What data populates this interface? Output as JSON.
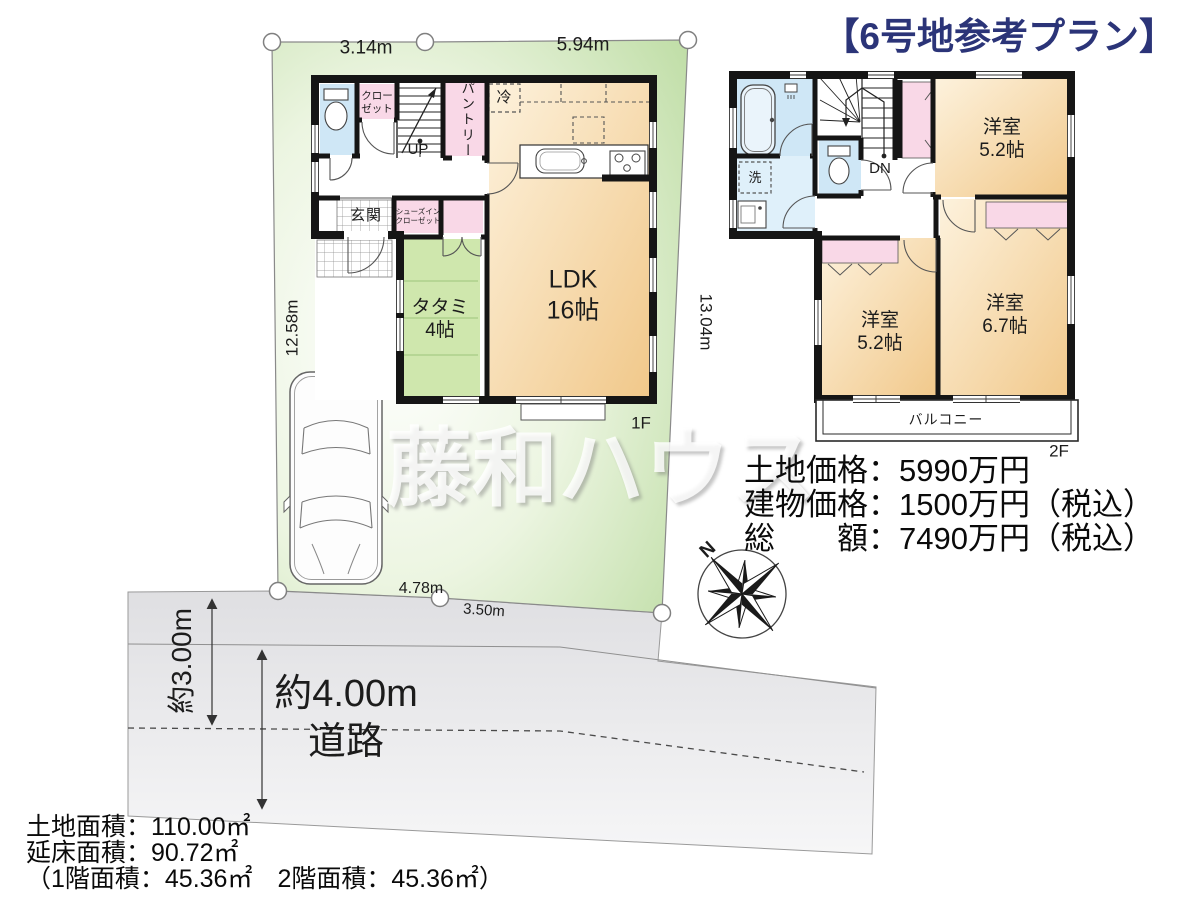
{
  "title": "【6号地参考プラン】",
  "title_color": "#2b3478",
  "watermark": "藤和ハウス",
  "compass_n": "N",
  "site_dims": {
    "top_left": "3.14m",
    "top_right": "5.94m",
    "left": "12.58m",
    "right": "13.04m",
    "bottom_left": "4.78m",
    "bottom_right": "3.50m"
  },
  "road": {
    "setback": "約3.00m",
    "width": "約4.00m",
    "label": "道路"
  },
  "floor1": {
    "label": "1F",
    "ldk": "LDK\n16帖",
    "tatami": "タタミ\n4帖",
    "genkan": "玄関",
    "closet": "クロー\nゼット",
    "pantry": "パントリー",
    "shoe_closet": "シューズイン\nクローゼット",
    "fridge": "冷",
    "stairs_up": "UP"
  },
  "floor2": {
    "label": "2F",
    "bedroom_a": "洋室\n5.2帖",
    "bedroom_b": "洋室\n5.2帖",
    "bedroom_c": "洋室\n6.7帖",
    "balcony": "バルコニー",
    "laundry": "洗",
    "stairs_down": "DN"
  },
  "prices": {
    "land": "土地価格：5990万円",
    "building": "建物価格：1500万円（税込）",
    "total": "総　　額：7490万円（税込）"
  },
  "areas": {
    "land": "土地面積：110.00㎡",
    "total_floor": "延床面積：90.72㎡",
    "breakdown": "（1階面積：45.36㎡　2階面積：45.36㎡）"
  }
}
